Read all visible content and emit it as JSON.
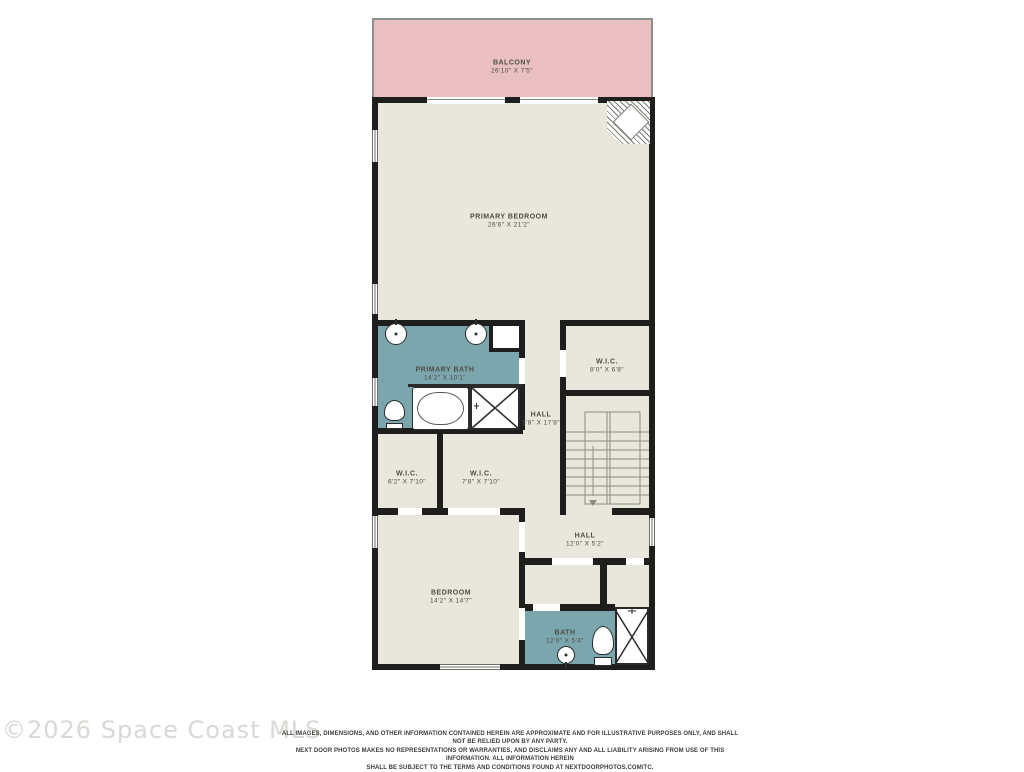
{
  "colors": {
    "wall": "#1e1e1c",
    "floor": "#e9e7dc",
    "wet_room": "#7ba6ad",
    "balcony": "#eabfc2",
    "label_text": "#4c4c46",
    "watermark": "#d9d8d4"
  },
  "rooms": [
    {
      "name": "BALCONY",
      "dims": "26'10\" X 7'5\""
    },
    {
      "name": "PRIMARY BEDROOM",
      "dims": "26'6\" X 21'2\""
    },
    {
      "name": "PRIMARY BATH",
      "dims": "14'2\" X 10'1\""
    },
    {
      "name": "W.I.C.",
      "dims": "8'0\" X 6'8\""
    },
    {
      "name": "HALL",
      "dims": "3'8\" X 17'8\""
    },
    {
      "name": "W.I.C.",
      "dims": "6'2\" X 7'10\""
    },
    {
      "name": "W.I.C.",
      "dims": "7'8\" X 7'10\""
    },
    {
      "name": "HALL",
      "dims": "12'0\" X 5'2\""
    },
    {
      "name": "BEDROOM",
      "dims": "14'2\" X 14'7\""
    },
    {
      "name": "BATH",
      "dims": "12'0\" X 5'4\""
    }
  ],
  "watermark": "©2026 Space Coast MLS",
  "disclaimer": {
    "line1": "ALL IMAGES, DIMENSIONS, AND OTHER INFORMATION CONTAINED HEREIN ARE APPROXIMATE AND FOR ILLUSTRATIVE PURPOSES ONLY, AND SHALL NOT BE RELIED UPON BY ANY PARTY.",
    "line2": "NEXT DOOR PHOTOS MAKES NO REPRESENTATIONS OR WARRANTIES, AND DISCLAIMS ANY AND ALL LIABILITY ARISING FROM USE OF THIS INFORMATION. ALL INFORMATION HEREIN",
    "line3": "SHALL BE SUBJECT TO THE TERMS AND CONDITIONS FOUND AT NEXTDOORPHOTOS.COM/TC."
  }
}
